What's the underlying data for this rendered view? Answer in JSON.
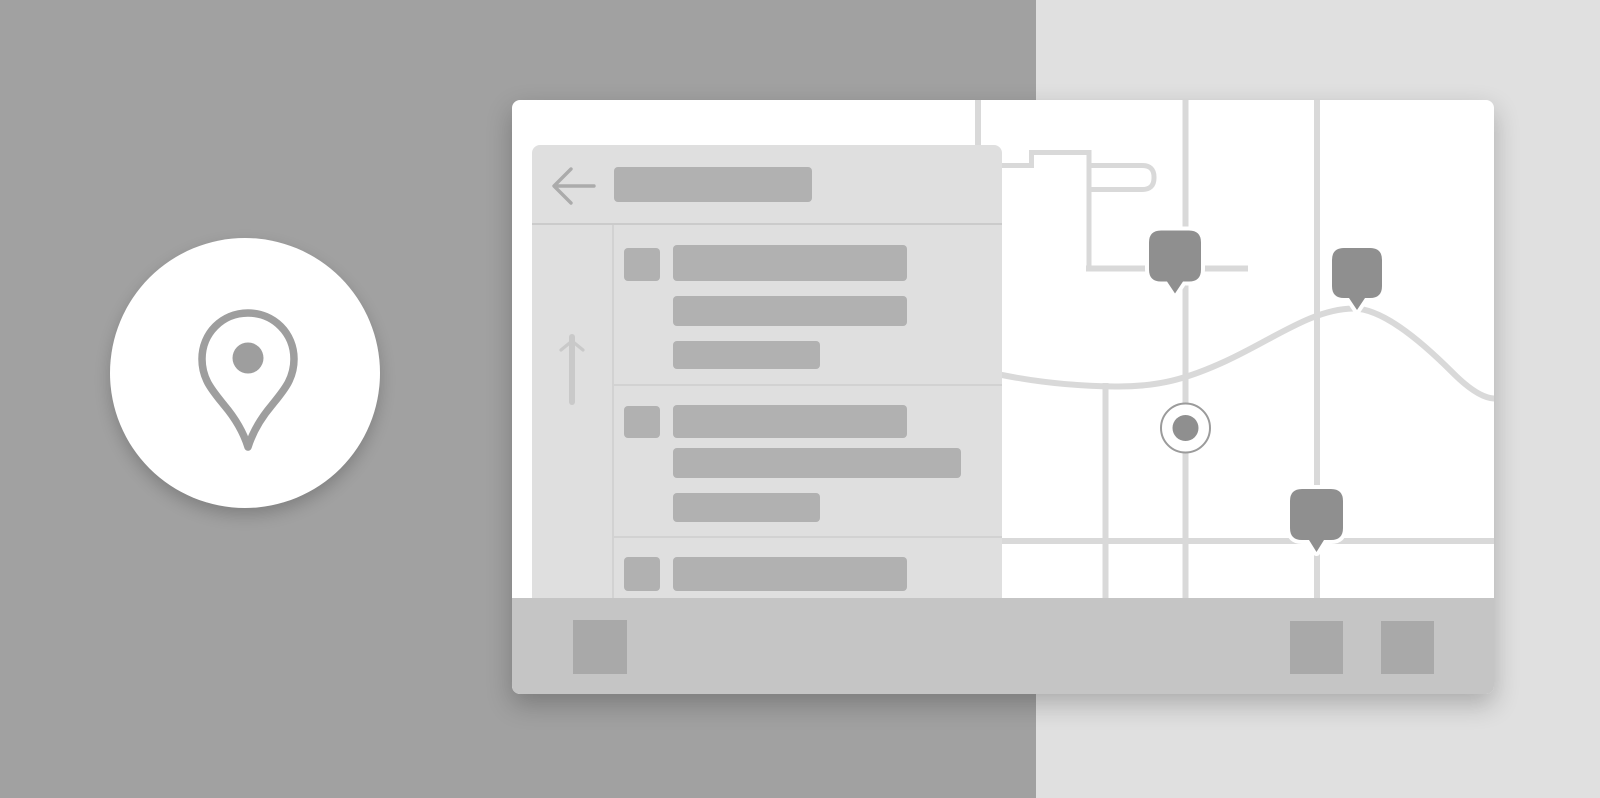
{
  "illustration": {
    "kind": "maps-app-wireframe",
    "badge": {
      "icon": "map-pin-icon"
    },
    "app_window": {
      "panel": {
        "header": {
          "back_icon": "arrow-left-icon",
          "title_placeholder": true
        },
        "scrollbar": {
          "up_icon": "chevron-up-icon",
          "down_icon": "chevron-down-icon",
          "thumb": true
        },
        "list_items": [
          {
            "checkbox_placeholder": true,
            "text_line_placeholders": 3
          },
          {
            "checkbox_placeholder": true,
            "text_line_placeholders": 3
          },
          {
            "checkbox_placeholder": true,
            "text_line_placeholders": 1
          }
        ]
      },
      "map": {
        "vertical_roads": 4,
        "horizontal_roads": 2,
        "curved_road": true,
        "block_outline": true,
        "markers": 3,
        "current_location_dot": true
      },
      "toolbar": {
        "buttons": 3
      }
    }
  },
  "colors": {
    "bg-left": "#a1a1a1",
    "bg-right": "#e0e0e0",
    "card-bg": "#ffffff",
    "panel-bg": "#dfdfdf",
    "bar": "#b1b1b1",
    "divider": "#d2d2d2",
    "divider-strong": "#cbcbcb",
    "road": "#d9d9d9",
    "marker": "#8f8f8f",
    "ring": "#9b9b9b",
    "bottombar": "#c5c5c5",
    "button": "#a9a9a9",
    "arrow": "#ababab",
    "chevron-up": "#c9c9c9",
    "chevron-down": "#a5a5a5",
    "thumb": "#c9c9c9",
    "pin": "#9e9e9e"
  }
}
